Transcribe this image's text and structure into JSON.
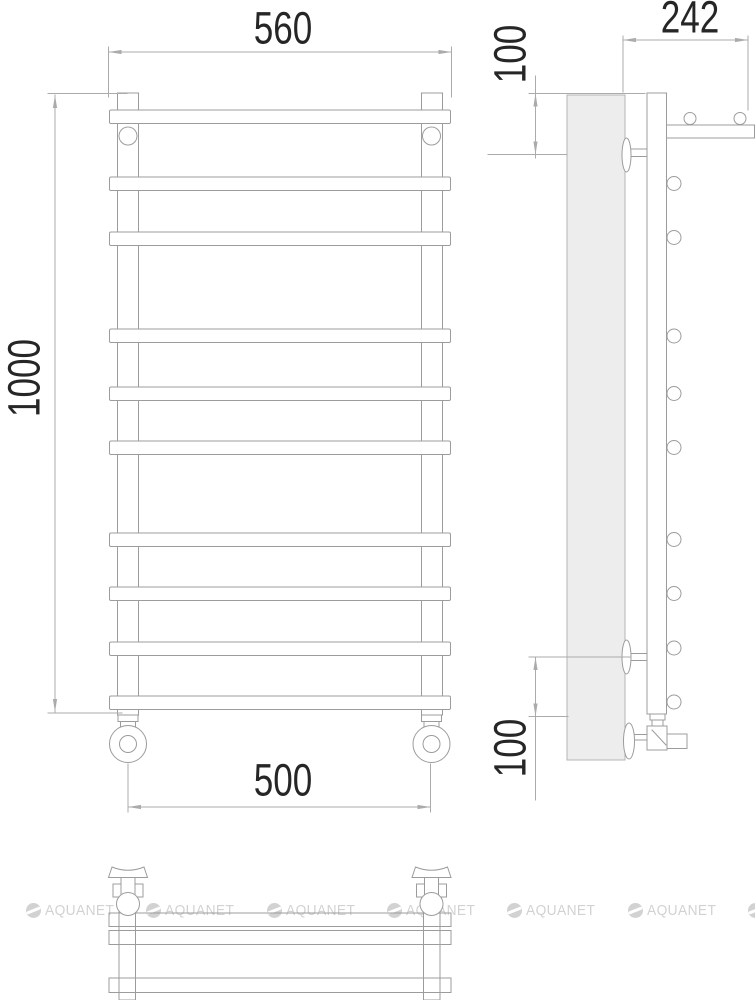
{
  "drawing_title": "towel-rail-dimension-drawing",
  "dimensions": {
    "overall_width": "560",
    "overall_height": "1000",
    "depth": "242",
    "top_offset": "100",
    "bottom_offset": "100",
    "connection_spacing": "500"
  },
  "watermark": {
    "text": "AQUANET"
  },
  "colors": {
    "line": "#9c9c9c",
    "dimension_line": "#ababab",
    "dimension_text": "#262626",
    "wall_fill": "#ededed",
    "watermark": "#d2d2d2"
  }
}
